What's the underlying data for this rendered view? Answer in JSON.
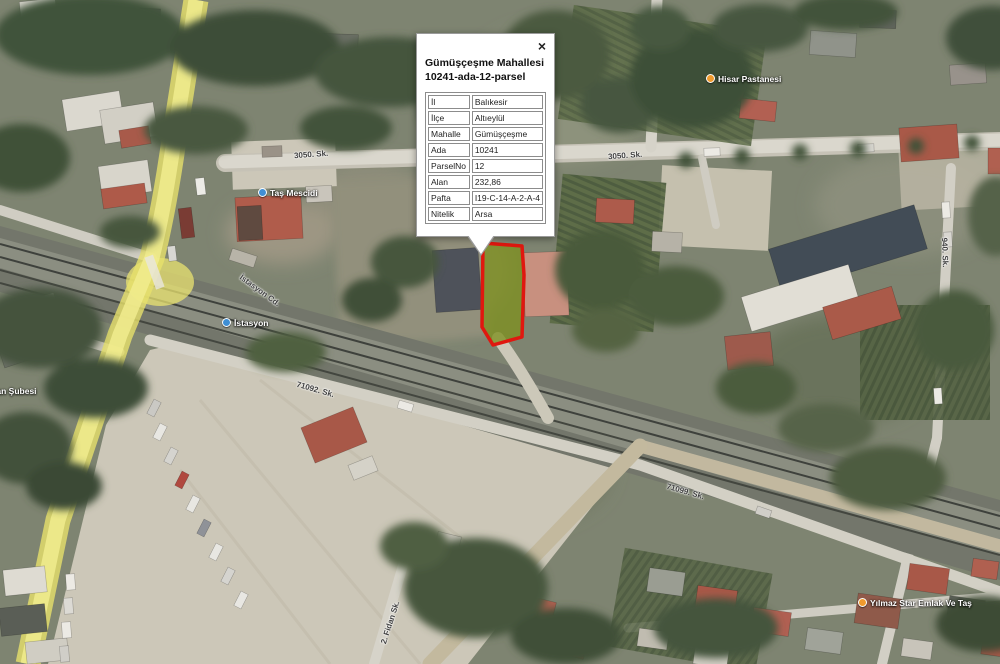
{
  "popup": {
    "close_label": "×",
    "title_line1": "Gümüşçeşme Mahallesi",
    "title_line2": "10241-ada-12-parsel",
    "rows": [
      {
        "label": "İl",
        "value": "Balıkesir"
      },
      {
        "label": "İlçe",
        "value": "Altıeylül"
      },
      {
        "label": "Mahalle",
        "value": "Gümüşçeşme"
      },
      {
        "label": "Ada",
        "value": "10241"
      },
      {
        "label": "ParselNo",
        "value": "12"
      },
      {
        "label": "Alan",
        "value": "232,86"
      },
      {
        "label": "Pafta",
        "value": "I19-C-14-A-2-A-4"
      },
      {
        "label": "Nitelik",
        "value": "Arsa"
      }
    ]
  },
  "map": {
    "street_labels": [
      {
        "text": "3050. Sk."
      },
      {
        "text": "3050. Sk."
      },
      {
        "text": "İstasyon Cd."
      },
      {
        "text": "71092. Sk."
      },
      {
        "text": "71099. Sk."
      },
      {
        "text": "2. Fidan Sk."
      },
      {
        "text": "940. Sk."
      }
    ],
    "poi_labels": [
      {
        "text": "Hisar Pastanesi"
      },
      {
        "text": "Taş Mescidi"
      },
      {
        "text": "İstasyon"
      },
      {
        "text": "oğan Şubesi"
      },
      {
        "text": "Yılmaz Star Emlak Ve Taş"
      }
    ]
  },
  "parcel": {
    "highlight_stroke": "#e0170f",
    "highlight_fill": "#7e8f1f"
  }
}
